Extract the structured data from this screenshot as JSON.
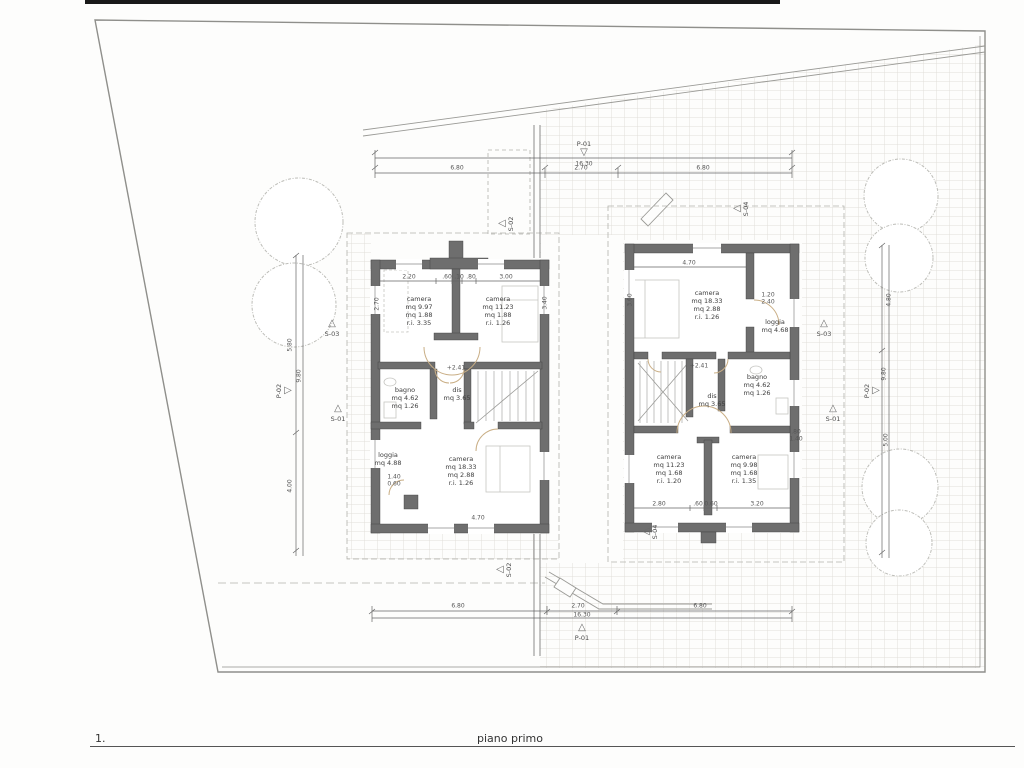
{
  "title": {
    "sheet_number": "1.",
    "caption": "piano primo"
  },
  "colors": {
    "wall": "#6e6e6e",
    "dim": "#555555",
    "hatch": "#e1dfda",
    "arc": "#c9ae85",
    "line": "#9a9a96"
  },
  "plan": {
    "rooms": [
      {
        "id": "left-camera-nw",
        "x": 419,
        "y": 311,
        "lines": [
          "camera",
          "mq 9.97",
          "mq 1.88",
          "r.i. 3.35"
        ]
      },
      {
        "id": "left-camera-ne",
        "x": 498,
        "y": 311,
        "lines": [
          "camera",
          "mq 11.23",
          "mq 1.88",
          "r.i. 1.26"
        ]
      },
      {
        "id": "left-bagno",
        "x": 405,
        "y": 398,
        "lines": [
          "bagno",
          "mq 4.62",
          "mq 1.26"
        ]
      },
      {
        "id": "left-dis",
        "x": 457,
        "y": 394,
        "lines": [
          "dis",
          "mq 3.65"
        ]
      },
      {
        "id": "left-loggia",
        "x": 388,
        "y": 459,
        "lines": [
          "loggia",
          "mq 4.88"
        ]
      },
      {
        "id": "left-camera-s",
        "x": 461,
        "y": 471,
        "lines": [
          "camera",
          "mq 18.33",
          "mq 2.88",
          "r.i. 1.26"
        ]
      },
      {
        "id": "right-camera-n",
        "x": 707,
        "y": 305,
        "lines": [
          "camera",
          "mq 18.33",
          "mq 2.88",
          "r.i. 1.26"
        ]
      },
      {
        "id": "right-loggia",
        "x": 775,
        "y": 326,
        "lines": [
          "loggia",
          "mq 4.68"
        ]
      },
      {
        "id": "right-bagno",
        "x": 757,
        "y": 385,
        "lines": [
          "bagno",
          "mq 4.62",
          "mq 1.26"
        ]
      },
      {
        "id": "right-dis",
        "x": 712,
        "y": 400,
        "lines": [
          "dis",
          "mq 3.65"
        ]
      },
      {
        "id": "right-camera-sw",
        "x": 669,
        "y": 469,
        "lines": [
          "camera",
          "mq 11.23",
          "mq 1.68",
          "r.i. 1.20"
        ]
      },
      {
        "id": "right-camera-se",
        "x": 744,
        "y": 469,
        "lines": [
          "camera",
          "mq 9.98",
          "mq 1.68",
          "r.i. 1.35"
        ]
      }
    ],
    "markers": [
      {
        "t": "down",
        "label": "P-01",
        "x": 584,
        "y": 153,
        "lx": 0,
        "ly": -9,
        "rot": false
      },
      {
        "t": "up",
        "label": "P-01",
        "x": 582,
        "y": 628,
        "lx": 0,
        "ly": 10,
        "rot": false
      },
      {
        "t": "right",
        "label": "P-02",
        "x": 288,
        "y": 391,
        "lx": -9,
        "ly": 0,
        "rot": true
      },
      {
        "t": "right",
        "label": "P-02",
        "x": 876,
        "y": 391,
        "lx": -9,
        "ly": 0,
        "rot": true
      },
      {
        "t": "left",
        "label": "S-02",
        "x": 502,
        "y": 224,
        "lx": 9,
        "ly": 0,
        "rot": true
      },
      {
        "t": "left",
        "label": "S-04",
        "x": 737,
        "y": 209,
        "lx": 9,
        "ly": 0,
        "rot": true
      },
      {
        "t": "up",
        "label": "S-03",
        "x": 332,
        "y": 324,
        "lx": 0,
        "ly": 10,
        "rot": false
      },
      {
        "t": "up",
        "label": "S-01",
        "x": 338,
        "y": 409,
        "lx": 0,
        "ly": 10,
        "rot": false
      },
      {
        "t": "up",
        "label": "S-03",
        "x": 824,
        "y": 324,
        "lx": 0,
        "ly": 10,
        "rot": false
      },
      {
        "t": "up",
        "label": "S-01",
        "x": 833,
        "y": 409,
        "lx": 0,
        "ly": 10,
        "rot": false
      },
      {
        "t": "left",
        "label": "S-02",
        "x": 500,
        "y": 570,
        "lx": 9,
        "ly": 0,
        "rot": true
      },
      {
        "t": "left",
        "label": "S-04",
        "x": 646,
        "y": 532,
        "lx": 9,
        "ly": 0,
        "rot": true
      }
    ],
    "dim_labels": [
      {
        "t": "16.30",
        "x": 584,
        "y": 164
      },
      {
        "t": "6.80",
        "x": 457,
        "y": 168
      },
      {
        "t": "2.70",
        "x": 581,
        "y": 168
      },
      {
        "t": "6.80",
        "x": 703,
        "y": 168
      },
      {
        "t": "6.80",
        "x": 458,
        "y": 606
      },
      {
        "t": "2.70",
        "x": 578,
        "y": 606
      },
      {
        "t": "6.80",
        "x": 700,
        "y": 606
      },
      {
        "t": "16.30",
        "x": 582,
        "y": 615
      },
      {
        "t": "5.80",
        "x": 290,
        "y": 345,
        "r": -90
      },
      {
        "t": "4.00",
        "x": 290,
        "y": 486,
        "r": -90
      },
      {
        "t": "9.80",
        "x": 299,
        "y": 376,
        "r": -90
      },
      {
        "t": "4.80",
        "x": 889,
        "y": 300,
        "r": -90
      },
      {
        "t": "5.00",
        "x": 886,
        "y": 440,
        "r": -90
      },
      {
        "t": "9.80",
        "x": 884,
        "y": 374,
        "r": -90
      },
      {
        "t": "2.20",
        "x": 409,
        "y": 277
      },
      {
        "t": ".60",
        "x": 447,
        "y": 277
      },
      {
        "t": ".10",
        "x": 459,
        "y": 277
      },
      {
        "t": ".80",
        "x": 471,
        "y": 277
      },
      {
        "t": "3.00",
        "x": 506,
        "y": 277
      },
      {
        "t": "2.70",
        "x": 377,
        "y": 304,
        "r": -90
      },
      {
        "t": "4.70",
        "x": 689,
        "y": 263
      },
      {
        "t": "4.70",
        "x": 478,
        "y": 518
      },
      {
        "t": "1.40",
        "x": 394,
        "y": 477
      },
      {
        "t": "0.60",
        "x": 394,
        "y": 484
      },
      {
        "t": "1.20",
        "x": 768,
        "y": 295
      },
      {
        "t": "2.40",
        "x": 768,
        "y": 302
      },
      {
        "t": ".80",
        "x": 796,
        "y": 432
      },
      {
        "t": "1.40",
        "x": 796,
        "y": 439
      },
      {
        "t": "2.80",
        "x": 659,
        "y": 504
      },
      {
        "t": ".60",
        "x": 698,
        "y": 504
      },
      {
        "t": "0.60",
        "x": 711,
        "y": 504
      },
      {
        "t": "3.20",
        "x": 757,
        "y": 504
      },
      {
        "t": "+2.41",
        "x": 456,
        "y": 368
      },
      {
        "t": "+2.41",
        "x": 699,
        "y": 366
      },
      {
        "t": "3.60",
        "x": 630,
        "y": 300,
        "r": -90
      },
      {
        "t": "3.40",
        "x": 545,
        "y": 303,
        "r": -90
      }
    ]
  }
}
